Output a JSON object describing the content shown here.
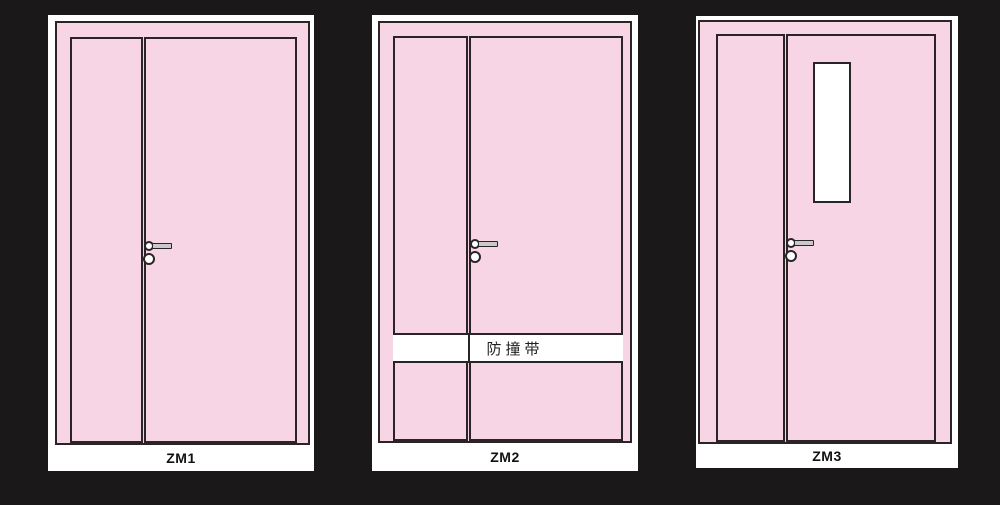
{
  "colors": {
    "bg": "#1b181a",
    "panel": "#ffffff",
    "pink": "#f8d5e5",
    "line": "#2a2426",
    "handle_gray": "#c9c9c9",
    "band": "#ffffff",
    "label_text": "#111111"
  },
  "doors": [
    {
      "label": "ZM1"
    },
    {
      "label": "ZM2",
      "band_label": "防撞带"
    },
    {
      "label": "ZM3"
    }
  ]
}
